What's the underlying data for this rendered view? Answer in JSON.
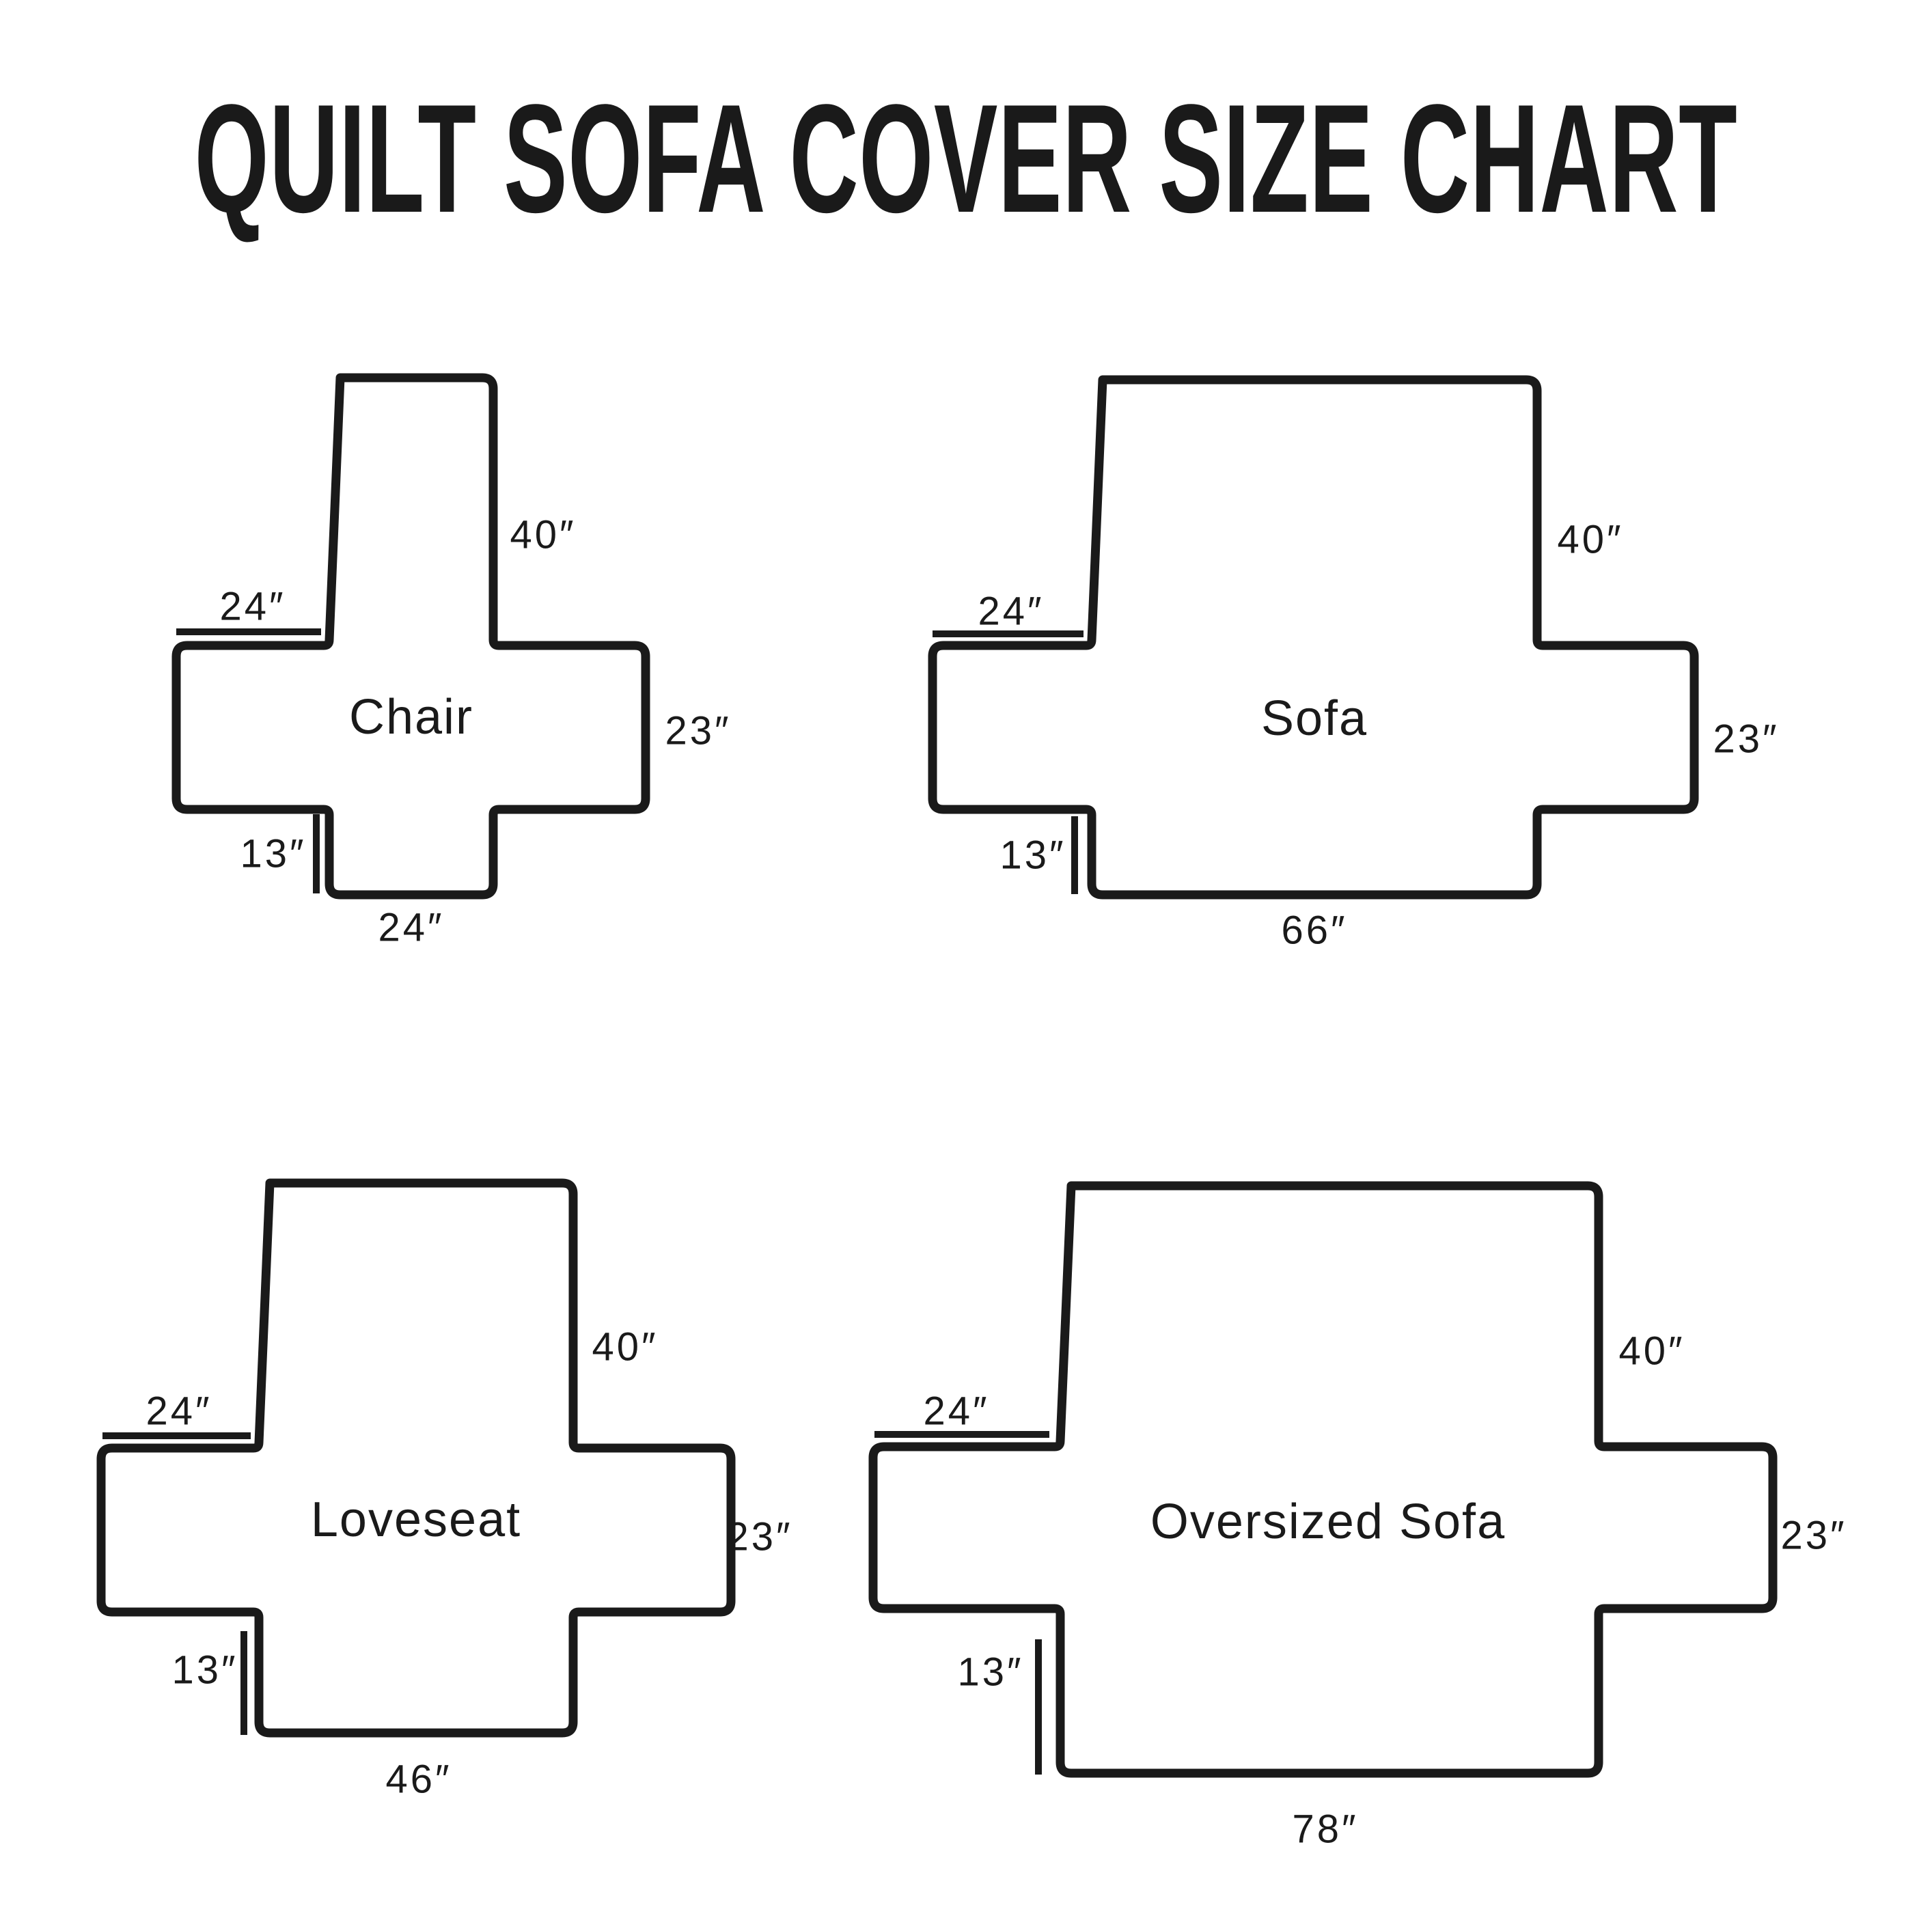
{
  "title": "QUILT SOFA COVER SIZE CHART",
  "colors": {
    "ink": "#1a1a1a",
    "background": "#ffffff"
  },
  "diagrams": [
    {
      "name": "Chair",
      "back_length": "40″",
      "arm_width": "24″",
      "side_height": "23″",
      "front_drop": "13″",
      "base_width": "24″"
    },
    {
      "name": "Sofa",
      "back_length": "40″",
      "arm_width": "24″",
      "side_height": "23″",
      "front_drop": "13″",
      "base_width": "66″"
    },
    {
      "name": "Loveseat",
      "back_length": "40″",
      "arm_width": "24″",
      "side_height": "23″",
      "front_drop": "13″",
      "base_width": "46″"
    },
    {
      "name": "Oversized Sofa",
      "back_length": "40″",
      "arm_width": "24″",
      "side_height": "23″",
      "front_drop": "13″",
      "base_width": "78″"
    }
  ]
}
